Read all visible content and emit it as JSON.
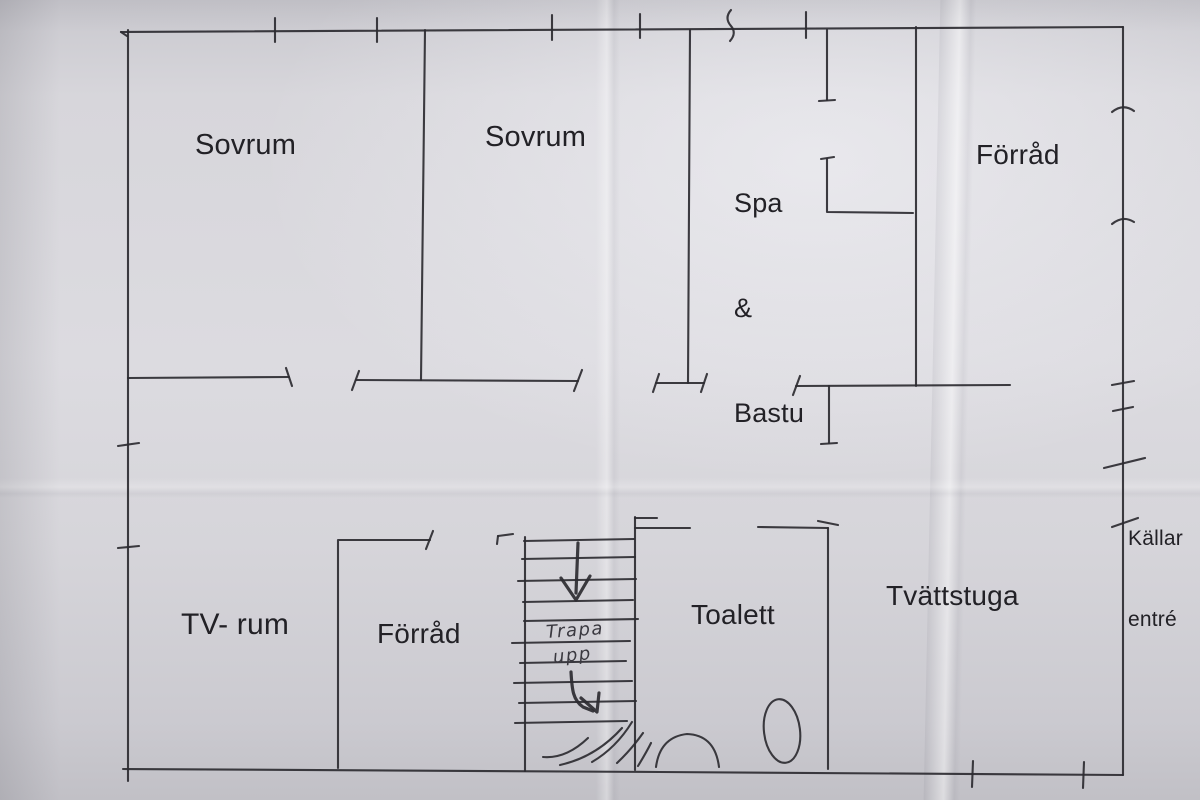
{
  "rooms": [
    {
      "id": "sovrum-1",
      "label": "Sovrum"
    },
    {
      "id": "sovrum-2",
      "label": "Sovrum"
    },
    {
      "id": "spa-bastu",
      "label": "Spa & Bastu",
      "line1": "Spa",
      "line2": "&",
      "line3": "Bastu"
    },
    {
      "id": "forrad-upper",
      "label": "Förråd"
    },
    {
      "id": "tv-rum",
      "label": "TV- rum"
    },
    {
      "id": "forrad-lower",
      "label": "Förråd"
    },
    {
      "id": "toalett",
      "label": "Toalett"
    },
    {
      "id": "tvattstuga",
      "label": "Tvättstuga"
    }
  ],
  "entrance": {
    "line1": "Källar",
    "line2": "entré"
  },
  "stairs": {
    "note_line1": "Trapa",
    "note_line2": "upp"
  },
  "colors": {
    "ink": "#2c2b31",
    "paper": "#d7d6db"
  }
}
